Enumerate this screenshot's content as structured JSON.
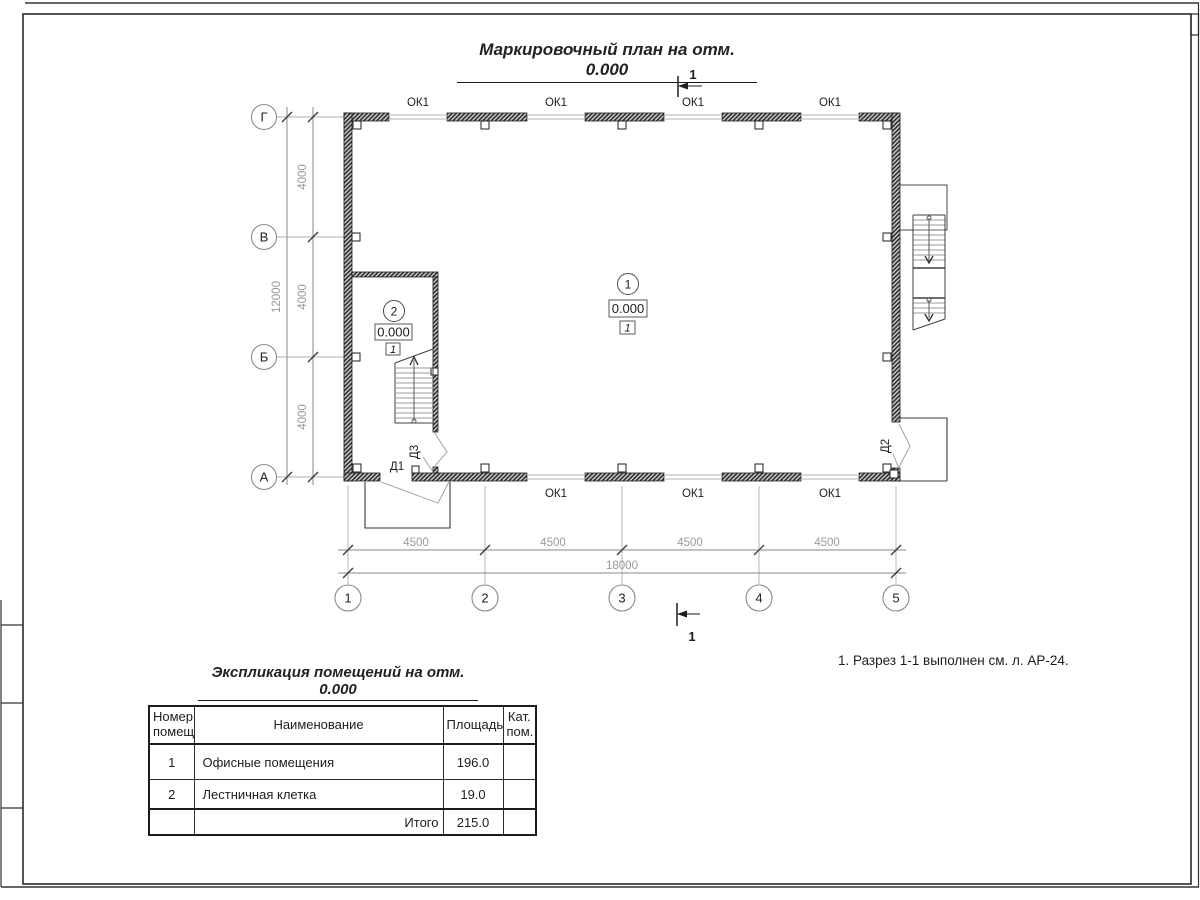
{
  "sheet": {
    "title": "Маркировочный план на отм. 0.000",
    "note": "1. Разрез 1-1 выполнен см. л. АР-24."
  },
  "plan": {
    "section": {
      "top": "1",
      "bottom": "1"
    },
    "window_label": "ОК1",
    "door_labels": {
      "d1": "Д1",
      "d2": "Д2",
      "d3": "Д3"
    },
    "axes": {
      "rows": [
        "Г",
        "В",
        "Б",
        "А"
      ],
      "cols": [
        "1",
        "2",
        "3",
        "4",
        "5"
      ]
    },
    "dims": {
      "left": [
        "4000",
        "4000",
        "4000"
      ],
      "left_total": "12000",
      "bottom": [
        "4500",
        "4500",
        "4500",
        "4500"
      ],
      "bottom_total": "18000"
    },
    "rooms": [
      {
        "number": "1",
        "elevation": "0.000",
        "finish": "1"
      },
      {
        "number": "2",
        "elevation": "0.000",
        "finish": "1"
      }
    ]
  },
  "table": {
    "title": "Экспликация помещений на отм. 0.000",
    "headers": [
      "Номер помещ.",
      "Наименование",
      "Площадь",
      "Кат. пом."
    ],
    "rows": [
      {
        "number": "1",
        "name": "Офисные помещения",
        "area": "196.0",
        "category": ""
      },
      {
        "number": "2",
        "name": "Лестничная клетка",
        "area": "19.0",
        "category": ""
      }
    ],
    "total_label": "Итого",
    "total_value": "215.0"
  },
  "colors": {
    "ink": "#222222",
    "dim_gray": "#9a9a9a",
    "wall": "#2e2e2e",
    "window_line": "#c4c4c4"
  }
}
